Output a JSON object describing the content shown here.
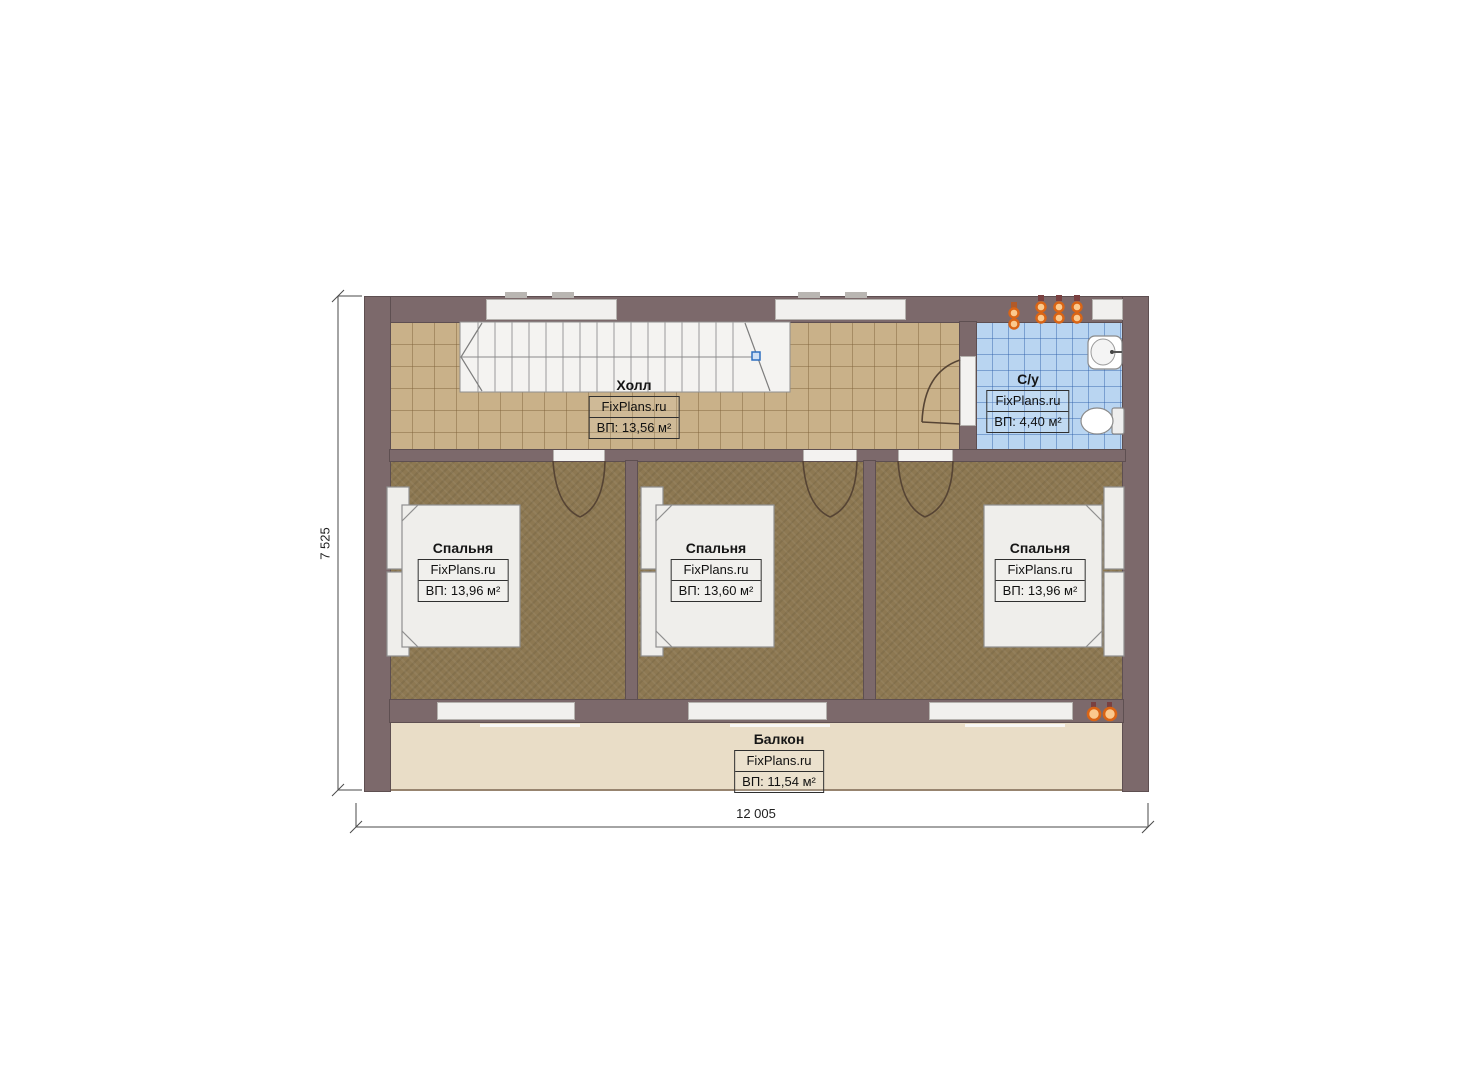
{
  "rooms": {
    "hall": {
      "name": "Холл",
      "watermark": "FixPlans.ru",
      "area": "ВП: 13,56 м²"
    },
    "bathroom": {
      "name": "С/у",
      "watermark": "FixPlans.ru",
      "area": "ВП: 4,40 м²"
    },
    "bedroom_left": {
      "name": "Спальня",
      "watermark": "FixPlans.ru",
      "area": "ВП: 13,96 м²"
    },
    "bedroom_middle": {
      "name": "Спальня",
      "watermark": "FixPlans.ru",
      "area": "ВП: 13,60 м²"
    },
    "bedroom_right": {
      "name": "Спальня",
      "watermark": "FixPlans.ru",
      "area": "ВП: 13,96 м²"
    },
    "balcony": {
      "name": "Балкон",
      "watermark": "FixPlans.ru",
      "area": "ВП: 11,54 м²"
    }
  },
  "dimensions": {
    "horizontal": "12 005",
    "vertical": "7 525"
  },
  "colors": {
    "wall": "#7c696b",
    "hall_floor": "#c9b189",
    "bathroom_floor": "#b9d5f1",
    "bedroom_floor": "#8d7852",
    "balcony_floor": "#e9ddc7",
    "vent_accent": "#e06a10",
    "stair_marker": "#4d82c4"
  }
}
